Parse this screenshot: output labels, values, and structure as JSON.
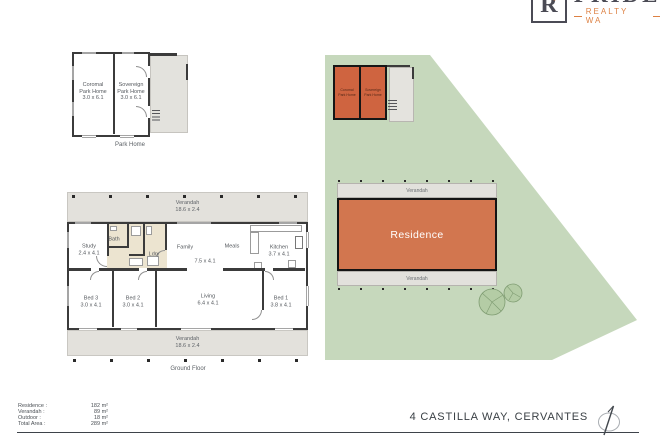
{
  "logo": {
    "letter": "R",
    "brand": "PRIDE",
    "tagline": "REALTY WA"
  },
  "park_home_plan": {
    "caption": "Park Home",
    "units": [
      {
        "name": "Coromal Park Home",
        "dims": "3.0 x 6.1"
      },
      {
        "name": "Sovereign Park Home",
        "dims": "3.0 x 6.1"
      }
    ]
  },
  "ground_floor": {
    "caption": "Ground Floor",
    "verandah_top": {
      "name": "Verandah",
      "dims": "18.6 x 2.4"
    },
    "verandah_bottom": {
      "name": "Verandah",
      "dims": "18.6 x 2.4"
    },
    "rooms": [
      {
        "name": "Study",
        "dims": "2.4 x 4.1"
      },
      {
        "name": "Bath",
        "dims": ""
      },
      {
        "name": "Ldry",
        "dims": ""
      },
      {
        "name": "Family",
        "dims": ""
      },
      {
        "name": "Meals",
        "dims": ""
      },
      {
        "name": "",
        "dims": "7.5 x 4.1"
      },
      {
        "name": "Kitchen",
        "dims": "3.7 x 4.1"
      },
      {
        "name": "Bed 3",
        "dims": "3.0 x 4.1"
      },
      {
        "name": "Bed 2",
        "dims": "3.0 x 4.1"
      },
      {
        "name": "Living",
        "dims": "6.4 x 4.1"
      },
      {
        "name": "Bed 1",
        "dims": "3.8 x 4.1"
      }
    ]
  },
  "site_plan": {
    "park_homes": [
      {
        "name": "Coromal Park Home"
      },
      {
        "name": "Sovereign Park Home"
      }
    ],
    "residence": "Residence",
    "verandah_top": "Verandah",
    "verandah_bottom": "Verandah"
  },
  "areas": {
    "rows": [
      {
        "label": "Residence :",
        "value": "182 m²"
      },
      {
        "label": "Verandah :",
        "value": "89 m²"
      },
      {
        "label": "Outdoor :",
        "value": "18 m²"
      },
      {
        "label": "Total Area :",
        "value": "289 m²"
      }
    ]
  },
  "footer": {
    "address": "4 CASTILLA WAY, CERVANTES"
  },
  "colors": {
    "site_green": "#c6d8bc",
    "residence_orange": "#d2764f",
    "park_home_orange": "#cf6440",
    "verandah_grey": "#e3e1dc",
    "wet_area_beige": "#ece4d0",
    "wall": "#3b3b3b",
    "brand_orange": "#dd8143",
    "text_dark": "#3a4045"
  }
}
